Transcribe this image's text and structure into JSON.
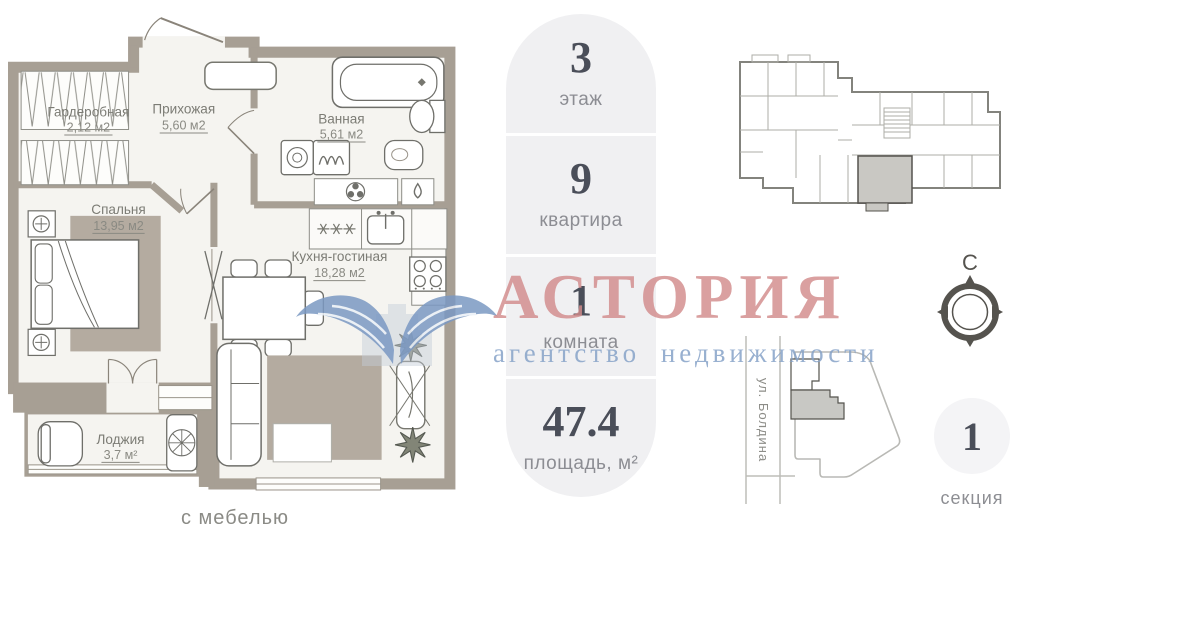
{
  "floorplan": {
    "rooms": [
      {
        "name": "Гардеробная",
        "area": "2,12 м2"
      },
      {
        "name": "Прихожая",
        "area": "5,60 м2"
      },
      {
        "name": "Ванная",
        "area": "5,61 м2"
      },
      {
        "name": "Спальня",
        "area": "13,95 м2"
      },
      {
        "name": "Кухня-гостиная",
        "area": "18,28 м2"
      },
      {
        "name": "Лоджия",
        "area": "3,7 м²"
      }
    ],
    "note": "с мебелью"
  },
  "info_panel": {
    "items": [
      {
        "value": "3",
        "label": "этаж"
      },
      {
        "value": "9",
        "label": "квартира"
      },
      {
        "value": "1",
        "label": "комната"
      },
      {
        "value": "47.4",
        "label": "площадь, м²"
      }
    ]
  },
  "watermark": {
    "title": "АСТОРИЯ",
    "subtitle": "агентство недвижимости"
  },
  "compass": {
    "north_label": "С"
  },
  "map": {
    "street_label": "ул. Болдина"
  },
  "section_badge": {
    "value": "1",
    "label": "секция"
  },
  "colors": {
    "walls": "#a79f94",
    "floor": "#f5f4f0",
    "rug": "#b4aba0",
    "panel_bg": "#f0f0f2",
    "number_text": "#4a4e59",
    "label_text": "#8c8d93",
    "watermark_red": "#d28c8c",
    "watermark_blue": "#87a3c8",
    "highlight_apartment": "#c9c8c3"
  }
}
